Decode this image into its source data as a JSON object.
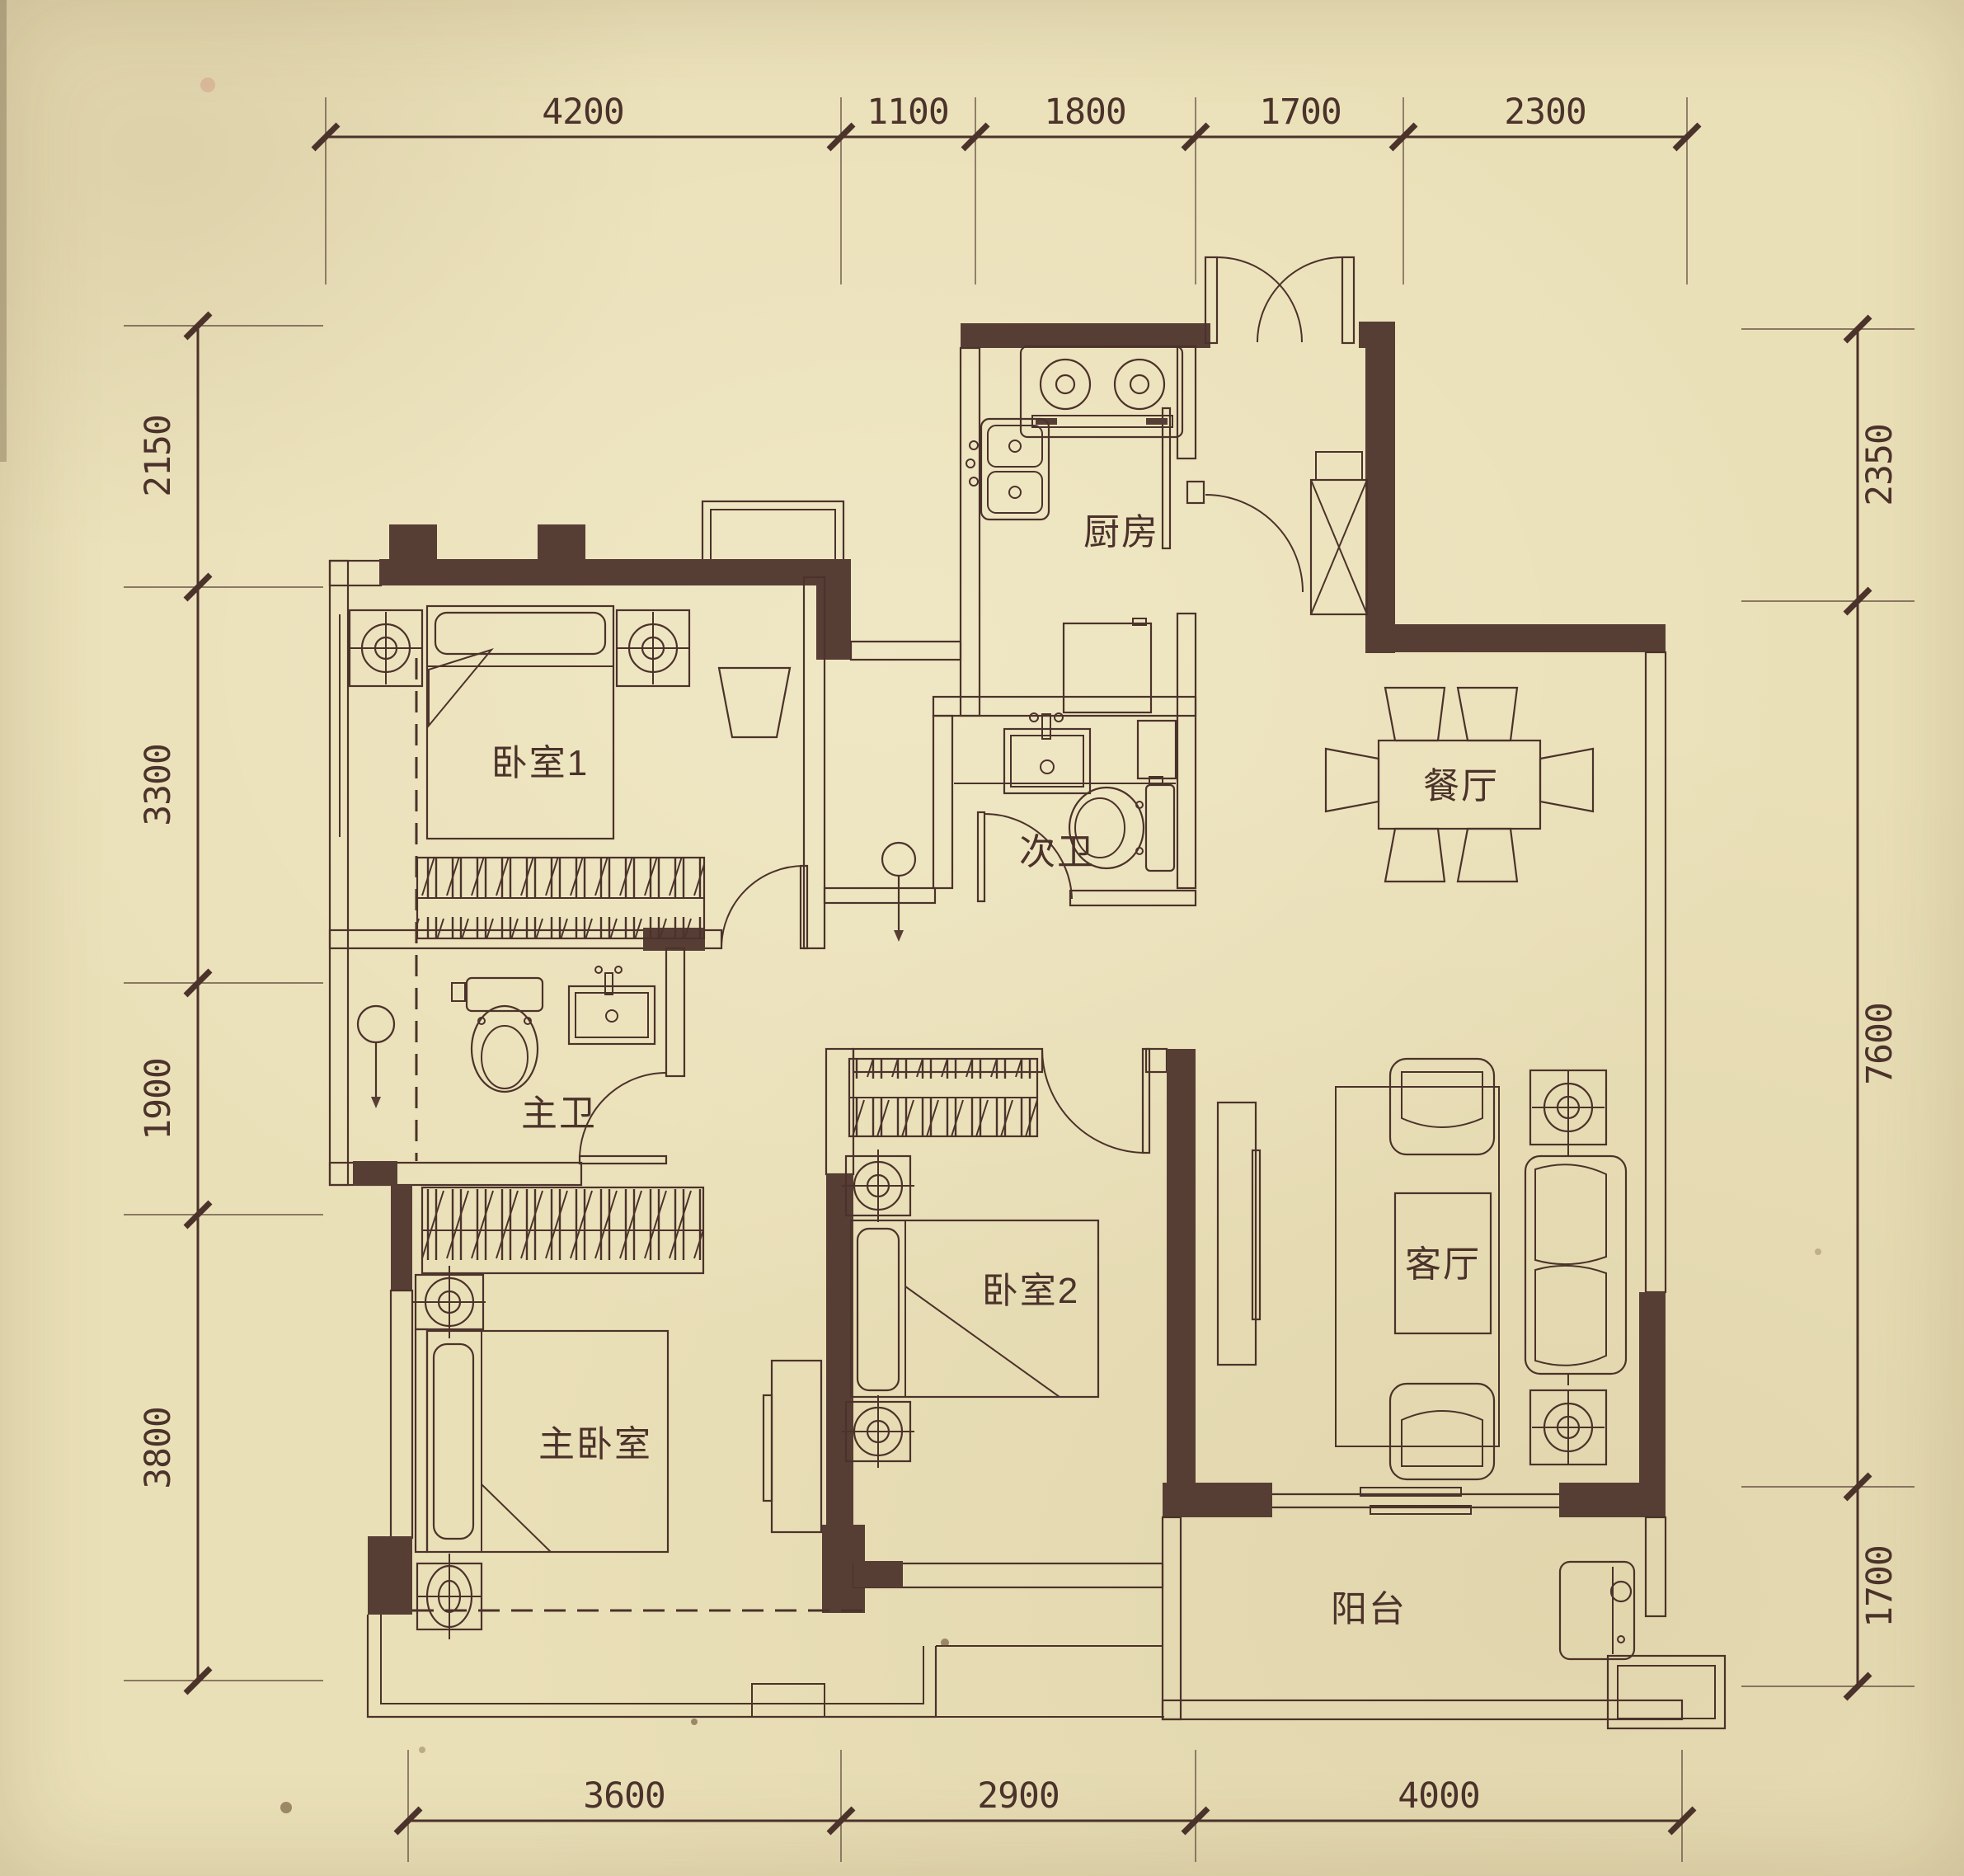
{
  "plan": {
    "type": "apartment-floor-plan",
    "colors": {
      "paper": "#eae0b8",
      "ink": "#4b322a",
      "wall": "#573e35"
    },
    "dims": {
      "top": [
        "4200",
        "1100",
        "1800",
        "1700",
        "2300"
      ],
      "bottom": [
        "3600",
        "2900",
        "4000"
      ],
      "left": [
        "2150",
        "3300",
        "1900",
        "3800"
      ],
      "right": [
        "2350",
        "7600",
        "1700"
      ]
    },
    "rooms": {
      "bedroom1": "卧室1",
      "kitchen": "厨房",
      "dining": "餐厅",
      "bath_secondary": "次卫",
      "bath_master": "主卫",
      "bedroom2": "卧室2",
      "master_bedroom": "主卧室",
      "living": "客厅",
      "balcony": "阳台"
    }
  }
}
